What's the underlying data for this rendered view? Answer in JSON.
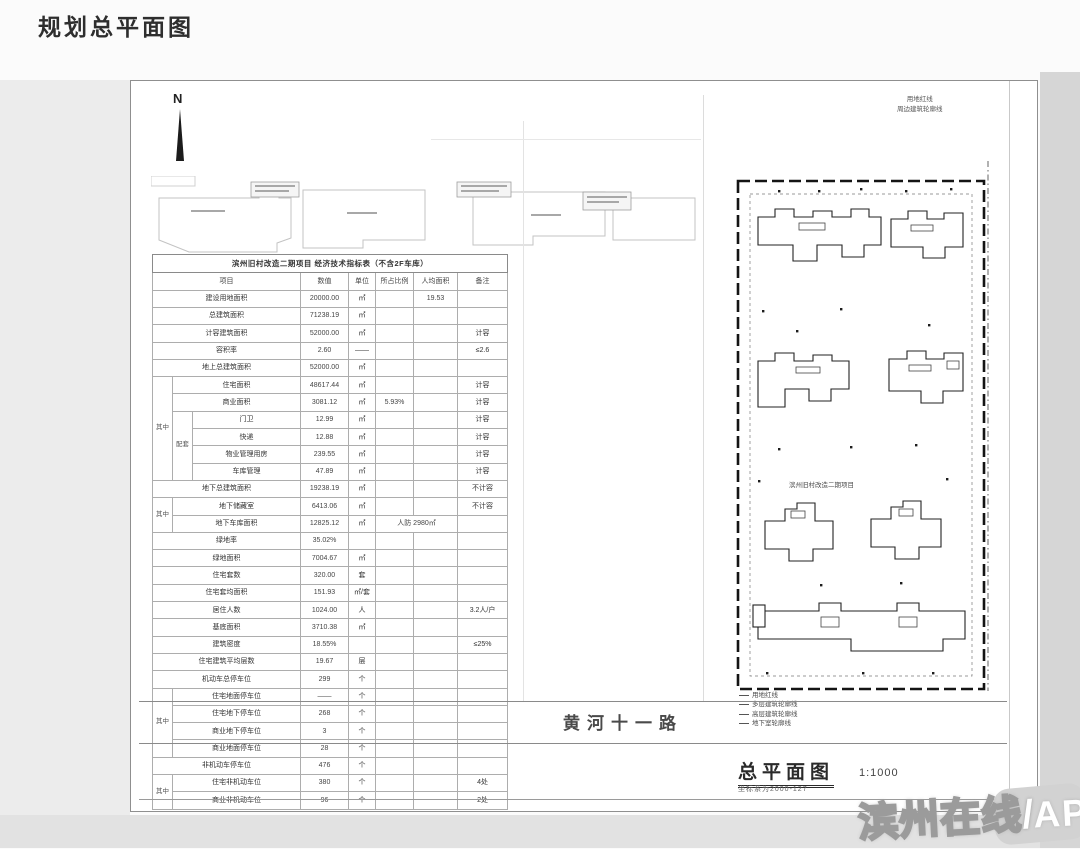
{
  "page": {
    "title": "规划总平面图"
  },
  "plan": {
    "north": "N",
    "center_label": "滨州旧村改造二期项目",
    "street": "黄河十一路",
    "title": "总平面图",
    "scale": "1:1000",
    "subtitle": "坐标系为2000-127",
    "legend_top": [
      "用地红线",
      "周边建筑轮廓线"
    ],
    "legend_bottom": [
      "用地红线",
      "多层建筑轮廓线",
      "高层建筑轮廓线",
      "地下室轮廓线"
    ],
    "watermark": {
      "name": "滨州在线",
      "slash": "/",
      "suffix": "APP"
    }
  },
  "table": {
    "title": "滨州旧村改造二期项目 经济技术指标表（不含2F车库）",
    "rows": [
      [
        {
          "t": "项目",
          "cs": 3,
          "cls": "hd"
        },
        {
          "t": "数值",
          "cls": "hd"
        },
        {
          "t": "单位",
          "cls": "hd"
        },
        {
          "t": "所占比例",
          "cls": "hd"
        },
        {
          "t": "人均面积",
          "cls": "hd"
        },
        {
          "t": "备注",
          "cls": "hd"
        }
      ],
      [
        {
          "t": "建设用地面积",
          "cs": 3
        },
        {
          "t": "20000.00",
          "cls": "val"
        },
        {
          "t": "㎡"
        },
        {
          "t": ""
        },
        {
          "t": "19.53",
          "cls": "val"
        },
        {
          "t": ""
        }
      ],
      [
        {
          "t": "总建筑面积",
          "cs": 3
        },
        {
          "t": "71238.19",
          "cls": "val"
        },
        {
          "t": "㎡"
        },
        {
          "t": ""
        },
        {
          "t": ""
        },
        {
          "t": ""
        }
      ],
      [
        {
          "t": "计容建筑面积",
          "cs": 3
        },
        {
          "t": "52000.00",
          "cls": "val"
        },
        {
          "t": "㎡"
        },
        {
          "t": ""
        },
        {
          "t": ""
        },
        {
          "t": "计容"
        }
      ],
      [
        {
          "t": "容积率",
          "cs": 3
        },
        {
          "t": "2.60",
          "cls": "val"
        },
        {
          "t": "——"
        },
        {
          "t": ""
        },
        {
          "t": ""
        },
        {
          "t": "≤2.6"
        }
      ],
      [
        {
          "t": "地上总建筑面积",
          "cs": 3
        },
        {
          "t": "52000.00",
          "cls": "val"
        },
        {
          "t": "㎡"
        },
        {
          "t": ""
        },
        {
          "t": ""
        },
        {
          "t": ""
        }
      ],
      [
        {
          "t": "其中",
          "rs": 6,
          "cls": "g"
        },
        {
          "t": "住宅面积",
          "cs": 2
        },
        {
          "t": "48617.44",
          "cls": "val"
        },
        {
          "t": "㎡"
        },
        {
          "t": ""
        },
        {
          "t": ""
        },
        {
          "t": "计容"
        }
      ],
      [
        {
          "t": "商业面积",
          "cs": 2
        },
        {
          "t": "3081.12",
          "cls": "val"
        },
        {
          "t": "㎡"
        },
        {
          "t": "5.93%",
          "cls": "val"
        },
        {
          "t": ""
        },
        {
          "t": "计容"
        }
      ],
      [
        {
          "t": "配套",
          "rs": 4,
          "cls": "g"
        },
        {
          "t": "门卫"
        },
        {
          "t": "12.99",
          "cls": "val"
        },
        {
          "t": "㎡"
        },
        {
          "t": ""
        },
        {
          "t": ""
        },
        {
          "t": "计容"
        }
      ],
      [
        {
          "t": "快递"
        },
        {
          "t": "12.88",
          "cls": "val"
        },
        {
          "t": "㎡"
        },
        {
          "t": ""
        },
        {
          "t": ""
        },
        {
          "t": "计容"
        }
      ],
      [
        {
          "t": "物业管理用房"
        },
        {
          "t": "239.55",
          "cls": "val"
        },
        {
          "t": "㎡"
        },
        {
          "t": ""
        },
        {
          "t": ""
        },
        {
          "t": "计容"
        }
      ],
      [
        {
          "t": "车库管理"
        },
        {
          "t": "47.89",
          "cls": "val"
        },
        {
          "t": "㎡"
        },
        {
          "t": ""
        },
        {
          "t": ""
        },
        {
          "t": "计容"
        }
      ],
      [
        {
          "t": "地下总建筑面积",
          "cs": 3
        },
        {
          "t": "19238.19",
          "cls": "val"
        },
        {
          "t": "㎡"
        },
        {
          "t": ""
        },
        {
          "t": ""
        },
        {
          "t": "不计容"
        }
      ],
      [
        {
          "t": "其中",
          "rs": 2,
          "cls": "g"
        },
        {
          "t": "地下储藏室",
          "cs": 2
        },
        {
          "t": "6413.06",
          "cls": "val"
        },
        {
          "t": "㎡"
        },
        {
          "t": ""
        },
        {
          "t": ""
        },
        {
          "t": "不计容"
        }
      ],
      [
        {
          "t": "地下车库面积",
          "cs": 2
        },
        {
          "t": "12825.12",
          "cls": "val"
        },
        {
          "t": "㎡"
        },
        {
          "t": "人防 2980㎡",
          "cs": 2,
          "cls": "val"
        },
        {
          "t": ""
        }
      ],
      [
        {
          "t": "绿地率",
          "cs": 3
        },
        {
          "t": "35.02%",
          "cls": "val"
        },
        {
          "t": ""
        },
        {
          "t": ""
        },
        {
          "t": ""
        },
        {
          "t": ""
        }
      ],
      [
        {
          "t": "绿地面积",
          "cs": 3
        },
        {
          "t": "7004.67",
          "cls": "val"
        },
        {
          "t": "㎡"
        },
        {
          "t": ""
        },
        {
          "t": ""
        },
        {
          "t": ""
        }
      ],
      [
        {
          "t": "住宅套数",
          "cs": 3
        },
        {
          "t": "320.00",
          "cls": "val"
        },
        {
          "t": "套"
        },
        {
          "t": ""
        },
        {
          "t": ""
        },
        {
          "t": ""
        }
      ],
      [
        {
          "t": "住宅套均面积",
          "cs": 3
        },
        {
          "t": "151.93",
          "cls": "val"
        },
        {
          "t": "㎡/套"
        },
        {
          "t": ""
        },
        {
          "t": ""
        },
        {
          "t": ""
        }
      ],
      [
        {
          "t": "居住人数",
          "cs": 3
        },
        {
          "t": "1024.00",
          "cls": "val"
        },
        {
          "t": "人"
        },
        {
          "t": ""
        },
        {
          "t": ""
        },
        {
          "t": "3.2人/户"
        }
      ],
      [
        {
          "t": "基底面积",
          "cs": 3
        },
        {
          "t": "3710.38",
          "cls": "val"
        },
        {
          "t": "㎡"
        },
        {
          "t": ""
        },
        {
          "t": ""
        },
        {
          "t": ""
        }
      ],
      [
        {
          "t": "建筑密度",
          "cs": 3
        },
        {
          "t": "18.55%",
          "cls": "val"
        },
        {
          "t": ""
        },
        {
          "t": ""
        },
        {
          "t": ""
        },
        {
          "t": "≤25%"
        }
      ],
      [
        {
          "t": "住宅建筑平均层数",
          "cs": 3
        },
        {
          "t": "19.67",
          "cls": "val"
        },
        {
          "t": "层"
        },
        {
          "t": ""
        },
        {
          "t": ""
        },
        {
          "t": ""
        }
      ],
      [
        {
          "t": "机动车总停车位",
          "cs": 3
        },
        {
          "t": "299",
          "cls": "val"
        },
        {
          "t": "个"
        },
        {
          "t": ""
        },
        {
          "t": ""
        },
        {
          "t": ""
        }
      ],
      [
        {
          "t": "其中",
          "rs": 4,
          "cls": "g"
        },
        {
          "t": "住宅地面停车位",
          "cs": 2
        },
        {
          "t": "——",
          "cls": "val"
        },
        {
          "t": "个"
        },
        {
          "t": ""
        },
        {
          "t": ""
        },
        {
          "t": ""
        }
      ],
      [
        {
          "t": "住宅地下停车位",
          "cs": 2
        },
        {
          "t": "268",
          "cls": "val"
        },
        {
          "t": "个"
        },
        {
          "t": ""
        },
        {
          "t": ""
        },
        {
          "t": ""
        }
      ],
      [
        {
          "t": "商业地下停车位",
          "cs": 2
        },
        {
          "t": "3",
          "cls": "val"
        },
        {
          "t": "个"
        },
        {
          "t": ""
        },
        {
          "t": ""
        },
        {
          "t": ""
        }
      ],
      [
        {
          "t": "商业地面停车位",
          "cs": 2
        },
        {
          "t": "28",
          "cls": "val"
        },
        {
          "t": "个"
        },
        {
          "t": ""
        },
        {
          "t": ""
        },
        {
          "t": ""
        }
      ],
      [
        {
          "t": "非机动车停车位",
          "cs": 3
        },
        {
          "t": "476",
          "cls": "val"
        },
        {
          "t": "个"
        },
        {
          "t": ""
        },
        {
          "t": ""
        },
        {
          "t": ""
        }
      ],
      [
        {
          "t": "其中",
          "rs": 2,
          "cls": "g vstack"
        },
        {
          "t": "住宅非机动车位",
          "cs": 2
        },
        {
          "t": "380",
          "cls": "val"
        },
        {
          "t": "个"
        },
        {
          "t": ""
        },
        {
          "t": ""
        },
        {
          "t": "4处"
        }
      ],
      [
        {
          "t": "商业非机动车位",
          "cs": 2
        },
        {
          "t": "96",
          "cls": "val"
        },
        {
          "t": "个"
        },
        {
          "t": ""
        },
        {
          "t": ""
        },
        {
          "t": "2处"
        }
      ]
    ]
  }
}
